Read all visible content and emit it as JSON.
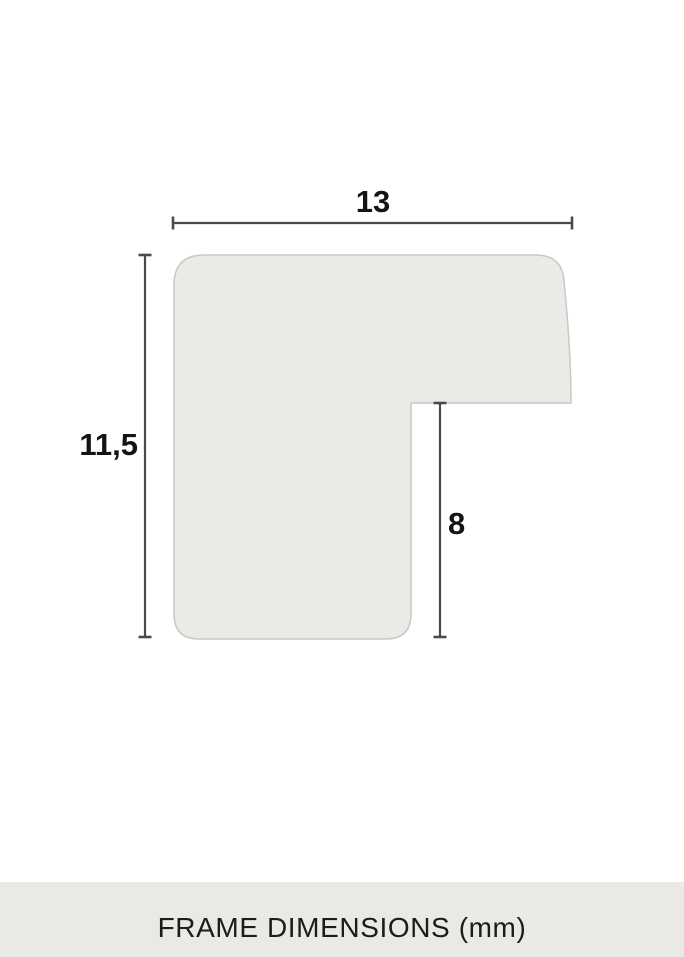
{
  "diagram": {
    "width_label": "13",
    "height_label": "11,5",
    "inner_height_label": "8",
    "shape_fill": "#eaeae7",
    "shape_stroke": "#c8c8c4",
    "dimension_line_color": "#4a4a4a",
    "label_color": "#141414"
  },
  "footer": {
    "label": "FRAME DIMENSIONS (mm)",
    "background": "#e9e9e5",
    "text_color": "#1c1c1a"
  }
}
